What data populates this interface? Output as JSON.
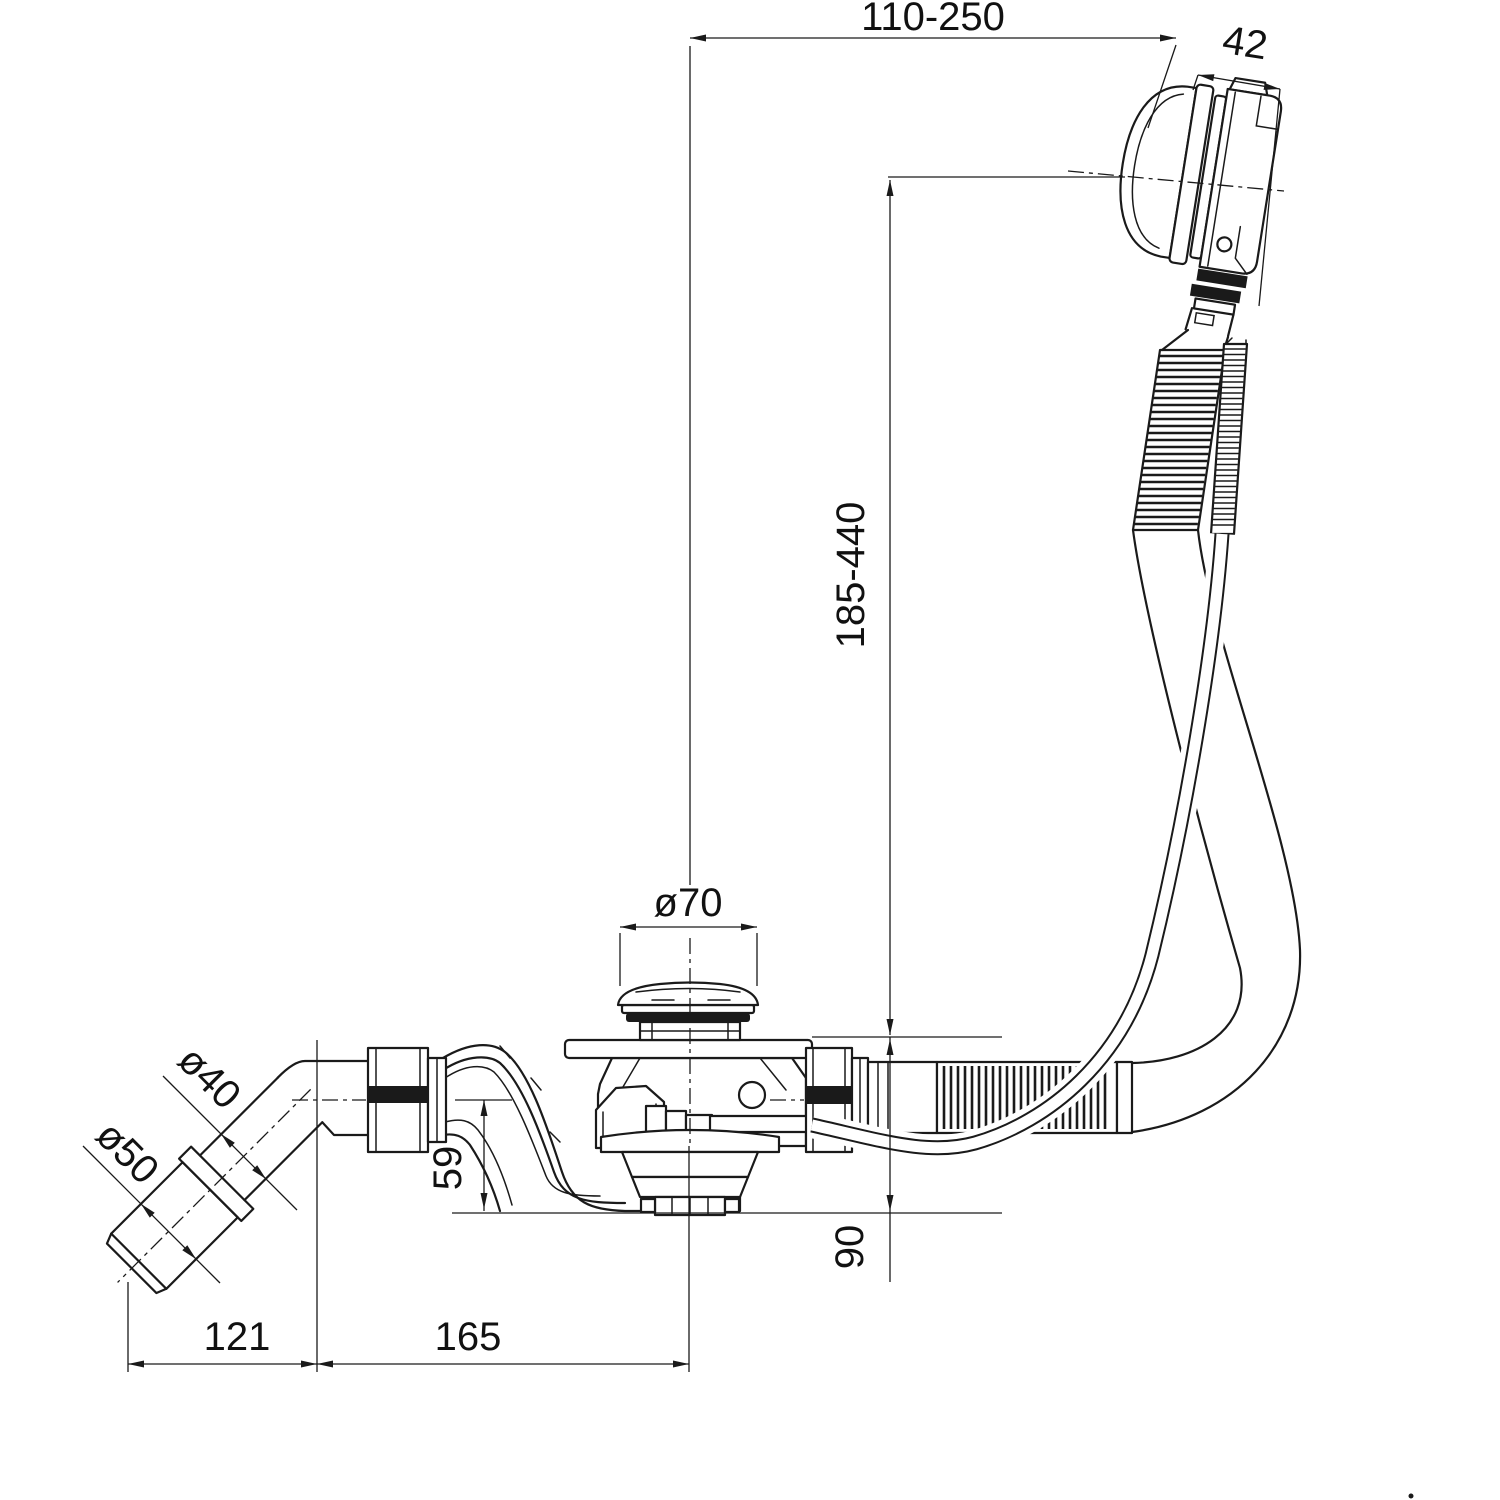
{
  "drawing": {
    "type": "technical-dimension-drawing",
    "subject": "bath-waste-and-overflow-kit-side-view",
    "colors": {
      "background": "#ffffff",
      "line": "#1a1a1a"
    },
    "dimensions": {
      "top_span": "110-250",
      "overflow_body_depth": "42",
      "overflow_height_range": "185-440",
      "waste_plug_diameter": "ø70",
      "outlet_pipe_diameter": "ø40",
      "outlet_socket_diameter": "ø50",
      "trap_depth": "59",
      "waste_height": "90",
      "elbow_offset": "121",
      "trap_length": "165"
    }
  }
}
